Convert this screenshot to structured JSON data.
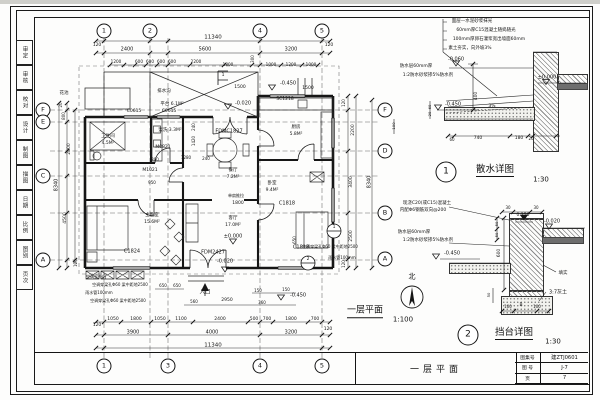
{
  "colors": {
    "line": "#1a1a1a",
    "paper": "#fdfdfc"
  },
  "frame": {
    "strip_labels": [
      "审定",
      "审核",
      "校对",
      "设计",
      "制图",
      "描图",
      "日期",
      "比例",
      "图别",
      "页次"
    ]
  },
  "title_block": {
    "drawing_title": "一层平面",
    "fields": [
      {
        "label": "图集号",
        "value": "建ZTJ0601"
      },
      {
        "label": "图 号",
        "value": "J-7"
      },
      {
        "label": "页",
        "value": "7"
      }
    ]
  },
  "plan": {
    "title": "一层平面",
    "scale": "1:100",
    "north": "北",
    "grid_top": [
      {
        "n": "1",
        "x": 104
      },
      {
        "n": "2",
        "x": 150
      },
      {
        "n": "4",
        "x": 260
      },
      {
        "n": "5",
        "x": 322
      }
    ],
    "grid_bottom": [
      {
        "n": "1",
        "x": 104
      },
      {
        "n": "3",
        "x": 168
      },
      {
        "n": "4",
        "x": 260
      },
      {
        "n": "5",
        "x": 322
      }
    ],
    "rows_left": [
      {
        "n": "F",
        "y": 110
      },
      {
        "n": "E",
        "y": 122
      },
      {
        "n": "C",
        "y": 176
      },
      {
        "n": "A",
        "y": 260
      }
    ],
    "rows_right": [
      {
        "n": "F",
        "y": 110
      },
      {
        "n": "D",
        "y": 151
      },
      {
        "n": "B",
        "y": 213
      },
      {
        "n": "A",
        "y": 259
      }
    ],
    "texts": [
      {
        "t": "11340",
        "x": 213,
        "y": 38,
        "s": 5.5
      },
      {
        "t": "120",
        "x": 97,
        "y": 46,
        "s": 4.5
      },
      {
        "t": "2400",
        "x": 127,
        "y": 50,
        "s": 5
      },
      {
        "t": "5600",
        "x": 205,
        "y": 50,
        "s": 5
      },
      {
        "t": "3200",
        "x": 291,
        "y": 50,
        "s": 5
      },
      {
        "t": "120",
        "x": 329,
        "y": 46,
        "s": 4.5
      },
      {
        "t": "1200",
        "x": 116,
        "y": 62,
        "s": 4.2
      },
      {
        "t": "600",
        "x": 139,
        "y": 62,
        "s": 4.2
      },
      {
        "t": "600",
        "x": 150,
        "y": 62,
        "s": 4.2
      },
      {
        "t": "600",
        "x": 161,
        "y": 62,
        "s": 4.2
      },
      {
        "t": "600",
        "x": 172,
        "y": 62,
        "s": 4.2
      },
      {
        "t": "2200",
        "x": 196,
        "y": 62,
        "s": 4.2
      },
      {
        "t": "1800",
        "x": 228,
        "y": 65,
        "s": 4.2
      },
      {
        "t": "300",
        "x": 253,
        "y": 59,
        "s": 4,
        "r": -90
      },
      {
        "t": "1000",
        "x": 271,
        "y": 65,
        "s": 4.2
      },
      {
        "t": "1200",
        "x": 291,
        "y": 65,
        "s": 4.2
      },
      {
        "t": "1000",
        "x": 311,
        "y": 65,
        "s": 4.2
      },
      {
        "t": "1500",
        "x": 240,
        "y": 88,
        "s": 4.5
      },
      {
        "t": "-0.450",
        "x": 288,
        "y": 84,
        "s": 5
      },
      {
        "t": "1500",
        "x": 308,
        "y": 89,
        "s": 4.5
      },
      {
        "t": "-0.020",
        "x": 243,
        "y": 104,
        "s": 5
      },
      {
        "t": "花池",
        "x": 64,
        "y": 94,
        "s": 4.5
      },
      {
        "t": "排水沟",
        "x": 164,
        "y": 92,
        "s": 4.5
      },
      {
        "t": "平台 6.1M²",
        "x": 172,
        "y": 105,
        "s": 4.5
      },
      {
        "t": "C0615",
        "x": 134,
        "y": 112,
        "s": 4.5
      },
      {
        "t": "C0615",
        "x": 169,
        "y": 112,
        "s": 4.5
      },
      {
        "t": "SC1218",
        "x": 285,
        "y": 100,
        "s": 4.5
      },
      {
        "t": "FDMC1827",
        "x": 229,
        "y": 132,
        "s": 5
      },
      {
        "t": "卫生间",
        "x": 108,
        "y": 137,
        "s": 4.5
      },
      {
        "t": "4.5M²",
        "x": 108,
        "y": 144,
        "s": 4.5
      },
      {
        "t": "盥洗 3.3M²",
        "x": 170,
        "y": 131,
        "s": 4.5
      },
      {
        "t": "厨房",
        "x": 296,
        "y": 128,
        "s": 4.5
      },
      {
        "t": "5.8M²",
        "x": 296,
        "y": 135,
        "s": 4.5
      },
      {
        "t": "M0821",
        "x": 163,
        "y": 148,
        "s": 4.5
      },
      {
        "t": "240",
        "x": 194,
        "y": 127,
        "s": 4,
        "r": -90
      },
      {
        "t": "1420",
        "x": 194,
        "y": 141,
        "s": 4,
        "r": -90
      },
      {
        "t": "800",
        "x": 155,
        "y": 160,
        "s": 4
      },
      {
        "t": "1280",
        "x": 186,
        "y": 158,
        "s": 4
      },
      {
        "t": "240",
        "x": 206,
        "y": 159,
        "s": 4
      },
      {
        "t": "餐厅",
        "x": 233,
        "y": 171,
        "s": 4.5
      },
      {
        "t": "7.2M²",
        "x": 233,
        "y": 178,
        "s": 4.5
      },
      {
        "t": "M1021",
        "x": 150,
        "y": 171,
        "s": 4.5
      },
      {
        "t": "950",
        "x": 152,
        "y": 183,
        "s": 4
      },
      {
        "t": "C1818",
        "x": 287,
        "y": 204,
        "s": 5
      },
      {
        "t": "卧室",
        "x": 272,
        "y": 184,
        "s": 4.5
      },
      {
        "t": "9.4M²",
        "x": 272,
        "y": 191,
        "s": 4.5
      },
      {
        "t": "单扇推拉",
        "x": 236,
        "y": 196,
        "s": 4
      },
      {
        "t": "1800",
        "x": 238,
        "y": 204,
        "s": 4.5
      },
      {
        "t": "主卧室",
        "x": 152,
        "y": 216,
        "s": 4.5
      },
      {
        "t": "15.6M²",
        "x": 152,
        "y": 223,
        "s": 4.5
      },
      {
        "t": "客厅",
        "x": 233,
        "y": 219,
        "s": 4.5
      },
      {
        "t": "17.0M²",
        "x": 233,
        "y": 226,
        "s": 4.5
      },
      {
        "t": "±0.000",
        "x": 233,
        "y": 237,
        "s": 5
      },
      {
        "t": "650",
        "x": 295,
        "y": 240,
        "s": 4,
        "r": -90
      },
      {
        "t": "C1824",
        "x": 132,
        "y": 252,
        "s": 5
      },
      {
        "t": "FDM2427",
        "x": 213,
        "y": 253,
        "s": 5
      },
      {
        "t": "C1818",
        "x": 301,
        "y": 248,
        "s": 5
      },
      {
        "t": "-0.020",
        "x": 225,
        "y": 262,
        "s": 5
      },
      {
        "t": "空调室外机",
        "x": 96,
        "y": 277,
        "s": 4
      },
      {
        "t": "空调穿梁孔Φ60 梁中距地2500",
        "x": 120,
        "y": 285,
        "s": 4
      },
      {
        "t": "雨水管100mm",
        "x": 99,
        "y": 293,
        "s": 4
      },
      {
        "t": "空调穿梁孔Φ60 梁中距地2500",
        "x": 118,
        "y": 301,
        "s": 4
      },
      {
        "t": "入口",
        "x": 205,
        "y": 293,
        "s": 5.5
      },
      {
        "t": "650",
        "x": 163,
        "y": 286,
        "s": 4
      },
      {
        "t": "650",
        "x": 177,
        "y": 286,
        "s": 4
      },
      {
        "t": "560",
        "x": 194,
        "y": 302,
        "s": 4
      },
      {
        "t": "2950",
        "x": 227,
        "y": 301,
        "s": 4.5
      },
      {
        "t": "150",
        "x": 258,
        "y": 291,
        "s": 4
      },
      {
        "t": "360",
        "x": 262,
        "y": 303,
        "s": 4
      },
      {
        "t": "150",
        "x": 286,
        "y": 290,
        "s": 4
      },
      {
        "t": "-0.450",
        "x": 298,
        "y": 296,
        "s": 5
      },
      {
        "t": "1050",
        "x": 113,
        "y": 320,
        "s": 4.5
      },
      {
        "t": "1800",
        "x": 136,
        "y": 320,
        "s": 4.5
      },
      {
        "t": "1050",
        "x": 160,
        "y": 320,
        "s": 4.5
      },
      {
        "t": "1100",
        "x": 181,
        "y": 320,
        "s": 4.5
      },
      {
        "t": "2400",
        "x": 220,
        "y": 320,
        "s": 4.5
      },
      {
        "t": "500",
        "x": 254,
        "y": 320,
        "s": 4.5
      },
      {
        "t": "700",
        "x": 267,
        "y": 320,
        "s": 4.5
      },
      {
        "t": "1800",
        "x": 291,
        "y": 320,
        "s": 4.5
      },
      {
        "t": "700",
        "x": 315,
        "y": 320,
        "s": 4.5
      },
      {
        "t": "120",
        "x": 97,
        "y": 326,
        "s": 4.5
      },
      {
        "t": "3900",
        "x": 133,
        "y": 333,
        "s": 5
      },
      {
        "t": "4000",
        "x": 212,
        "y": 333,
        "s": 5
      },
      {
        "t": "3200",
        "x": 291,
        "y": 333,
        "s": 5
      },
      {
        "t": "120",
        "x": 328,
        "y": 330,
        "s": 4.5
      },
      {
        "t": "11340",
        "x": 213,
        "y": 346,
        "s": 5.5
      },
      {
        "t": "20",
        "x": 61,
        "y": 105,
        "s": 4,
        "r": -90
      },
      {
        "t": "800",
        "x": 64,
        "y": 116,
        "s": 4,
        "r": -90
      },
      {
        "t": "2800",
        "x": 70,
        "y": 149,
        "s": 4.5,
        "r": -90
      },
      {
        "t": "8340",
        "x": 57,
        "y": 185,
        "s": 5,
        "r": -90
      },
      {
        "t": "4500",
        "x": 66,
        "y": 218,
        "s": 4.5,
        "r": -90
      },
      {
        "t": "120",
        "x": 76,
        "y": 263,
        "s": 4,
        "r": -90
      },
      {
        "t": "120",
        "x": 344,
        "y": 103,
        "s": 4,
        "r": -90
      },
      {
        "t": "2200",
        "x": 354,
        "y": 130,
        "s": 4.5,
        "r": -90
      },
      {
        "t": "3400",
        "x": 352,
        "y": 182,
        "s": 4.5,
        "r": -90
      },
      {
        "t": "8340",
        "x": 370,
        "y": 182,
        "s": 5,
        "r": -90
      },
      {
        "t": "2500",
        "x": 352,
        "y": 236,
        "s": 4.5,
        "r": -90
      },
      {
        "t": "120",
        "x": 344,
        "y": 264,
        "s": 4,
        "r": -90
      },
      {
        "t": "空调穿梁孔Φ60 梁中距地2500",
        "x": 330,
        "y": 247,
        "s": 4
      },
      {
        "t": "雨水管100mm",
        "x": 342,
        "y": 258,
        "s": 4
      },
      {
        "t": "1",
        "x": 334,
        "y": 228,
        "s": 4.5
      },
      {
        "t": "2",
        "x": 308,
        "y": 260,
        "s": 4.5
      },
      {
        "t": "1",
        "x": 223,
        "y": 76,
        "s": 4.5
      },
      {
        "t": "北",
        "x": 412,
        "y": 277,
        "s": 7
      },
      {
        "t": "一层平面",
        "x": 365,
        "y": 312,
        "s": 9,
        "u": 1
      },
      {
        "t": "1:100",
        "x": 403,
        "y": 320,
        "s": 7
      }
    ]
  },
  "details": [
    {
      "num": "1",
      "title": "散水详图",
      "scale": "1:30",
      "bubble": {
        "x": 446,
        "y": 172
      },
      "texts": [
        {
          "t": "面层—水泥砂浆抹光",
          "x": 472,
          "y": 22,
          "s": 4.5
        },
        {
          "t": "60mm厚C15混凝土随捣随光",
          "x": 486,
          "y": 31,
          "s": 4.5
        },
        {
          "t": "100mm厚卵石灌浆宽出墙面60mm",
          "x": 489,
          "y": 40,
          "s": 4.5
        },
        {
          "t": "素土夯实，向外坡3%",
          "x": 470,
          "y": 49,
          "s": 4.5
        },
        {
          "t": "-0.060",
          "x": 456,
          "y": 60,
          "s": 5
        },
        {
          "t": "防水层60mm厚",
          "x": 416,
          "y": 67,
          "s": 4.5
        },
        {
          "t": "1:2防水砂浆掺5%防水剂",
          "x": 428,
          "y": 76,
          "s": 4.5
        },
        {
          "t": "±0.000",
          "x": 547,
          "y": 78,
          "s": 5
        },
        {
          "t": "400",
          "x": 477,
          "y": 96,
          "s": 4.5,
          "r": -90
        },
        {
          "t": "-0.450",
          "x": 453,
          "y": 105,
          "s": 5
        },
        {
          "t": "3%",
          "x": 492,
          "y": 107,
          "s": 4.5
        },
        {
          "t": "60",
          "x": 430,
          "y": 107,
          "s": 3.8,
          "r": -90
        },
        {
          "t": "20",
          "x": 430,
          "y": 114,
          "s": 3.8,
          "r": -90
        },
        {
          "t": "100",
          "x": 394,
          "y": 126,
          "s": 3.8,
          "r": -90
        },
        {
          "t": "60",
          "x": 452,
          "y": 140,
          "s": 4
        },
        {
          "t": "740",
          "x": 478,
          "y": 139,
          "s": 4.5
        },
        {
          "t": "180",
          "x": 519,
          "y": 139,
          "s": 4.5
        },
        {
          "t": "20",
          "x": 531,
          "y": 139,
          "s": 4
        },
        {
          "t": "散水详图",
          "x": 495,
          "y": 171,
          "s": 9.5,
          "u": 1
        },
        {
          "t": "1:30",
          "x": 541,
          "y": 180,
          "s": 7
        }
      ]
    },
    {
      "num": "2",
      "title": "挡台详图",
      "scale": "1:30",
      "bubble": {
        "x": 468,
        "y": 335
      },
      "texts": [
        {
          "t": "现浇C20(或C15)混凝土",
          "x": 427,
          "y": 204,
          "s": 4.5
        },
        {
          "t": "内配Φ6钢筋双向@200",
          "x": 423,
          "y": 211,
          "s": 4.5
        },
        {
          "t": "30",
          "x": 508,
          "y": 208,
          "s": 4
        },
        {
          "t": "30",
          "x": 536,
          "y": 208,
          "s": 4
        },
        {
          "t": "0.150",
          "x": 523,
          "y": 216,
          "s": 4.5
        },
        {
          "t": "-0.020",
          "x": 552,
          "y": 222,
          "s": 5
        },
        {
          "t": "50",
          "x": 497,
          "y": 224,
          "s": 3.8,
          "r": -90
        },
        {
          "t": "50",
          "x": 497,
          "y": 235,
          "s": 3.8,
          "r": -90
        },
        {
          "t": "防水层60mm厚",
          "x": 414,
          "y": 233,
          "s": 4.5
        },
        {
          "t": "1:2防水砂浆掺5%防水剂",
          "x": 428,
          "y": 241,
          "s": 4.5
        },
        {
          "t": "600",
          "x": 500,
          "y": 253,
          "s": 4.5,
          "r": -90
        },
        {
          "t": "-0.450",
          "x": 452,
          "y": 254,
          "s": 5
        },
        {
          "t": "填实",
          "x": 563,
          "y": 274,
          "s": 4.5
        },
        {
          "t": "3:7灰土",
          "x": 558,
          "y": 293,
          "s": 5
        },
        {
          "t": "50",
          "x": 489,
          "y": 295,
          "s": 3.8,
          "r": -90
        },
        {
          "t": "100",
          "x": 508,
          "y": 307,
          "s": 4
        },
        {
          "t": "B",
          "x": 521,
          "y": 306,
          "s": 4.5
        },
        {
          "t": "100",
          "x": 537,
          "y": 307,
          "s": 4
        },
        {
          "t": "挡台详图",
          "x": 514,
          "y": 334,
          "s": 9.5,
          "u": 1
        },
        {
          "t": "1:30",
          "x": 553,
          "y": 342,
          "s": 7
        }
      ]
    }
  ]
}
